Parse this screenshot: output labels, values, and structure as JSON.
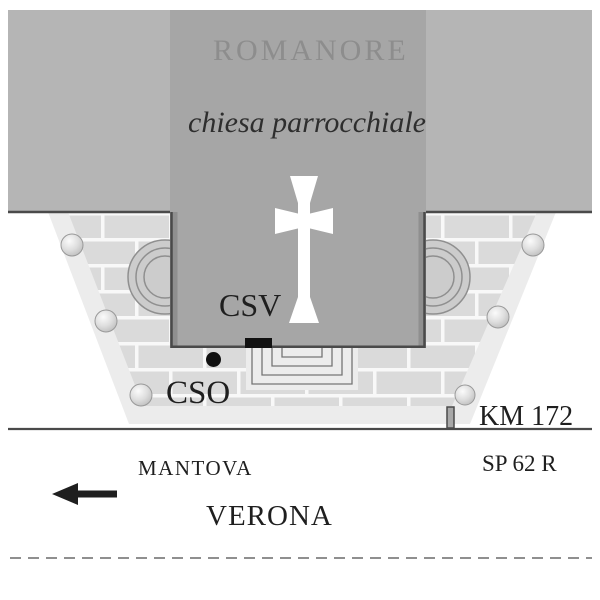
{
  "map": {
    "town": "ROMANORE",
    "building_subtitle": "chiesa parrocchiale",
    "marker_csv_label": "CSV",
    "marker_cso_label": "CSO",
    "km_label": "KM 172",
    "road_name": "SP 62 R",
    "direction_near": "MANTOVA",
    "direction_far": "VERONA"
  },
  "icons": {
    "cross": "latin-cross",
    "direction_arrow": "arrow-left",
    "bollard": "sphere-bollard",
    "km_post": "kilometre-post"
  },
  "colors": {
    "block_light": "#b5b5b5",
    "block_mid": "#a6a6a6",
    "outline": "#4a4a4a",
    "band": "#ececec",
    "brick": "#dadada",
    "grout": "#f8f8f8",
    "apse_fill": "#cccccc",
    "apse_stroke": "#8f8f8f",
    "steps_fill": "#ececec",
    "steps_stroke": "#757575",
    "text_dark": "#1f1f1f",
    "town_text": "#8d8d8d",
    "marker_black": "#111111",
    "cross_white": "#ffffff",
    "dash": "#8f8f8f",
    "post_fill": "#a8a8a8",
    "wall_shade": "#8f8f8f",
    "ball_rim": "#999999"
  }
}
